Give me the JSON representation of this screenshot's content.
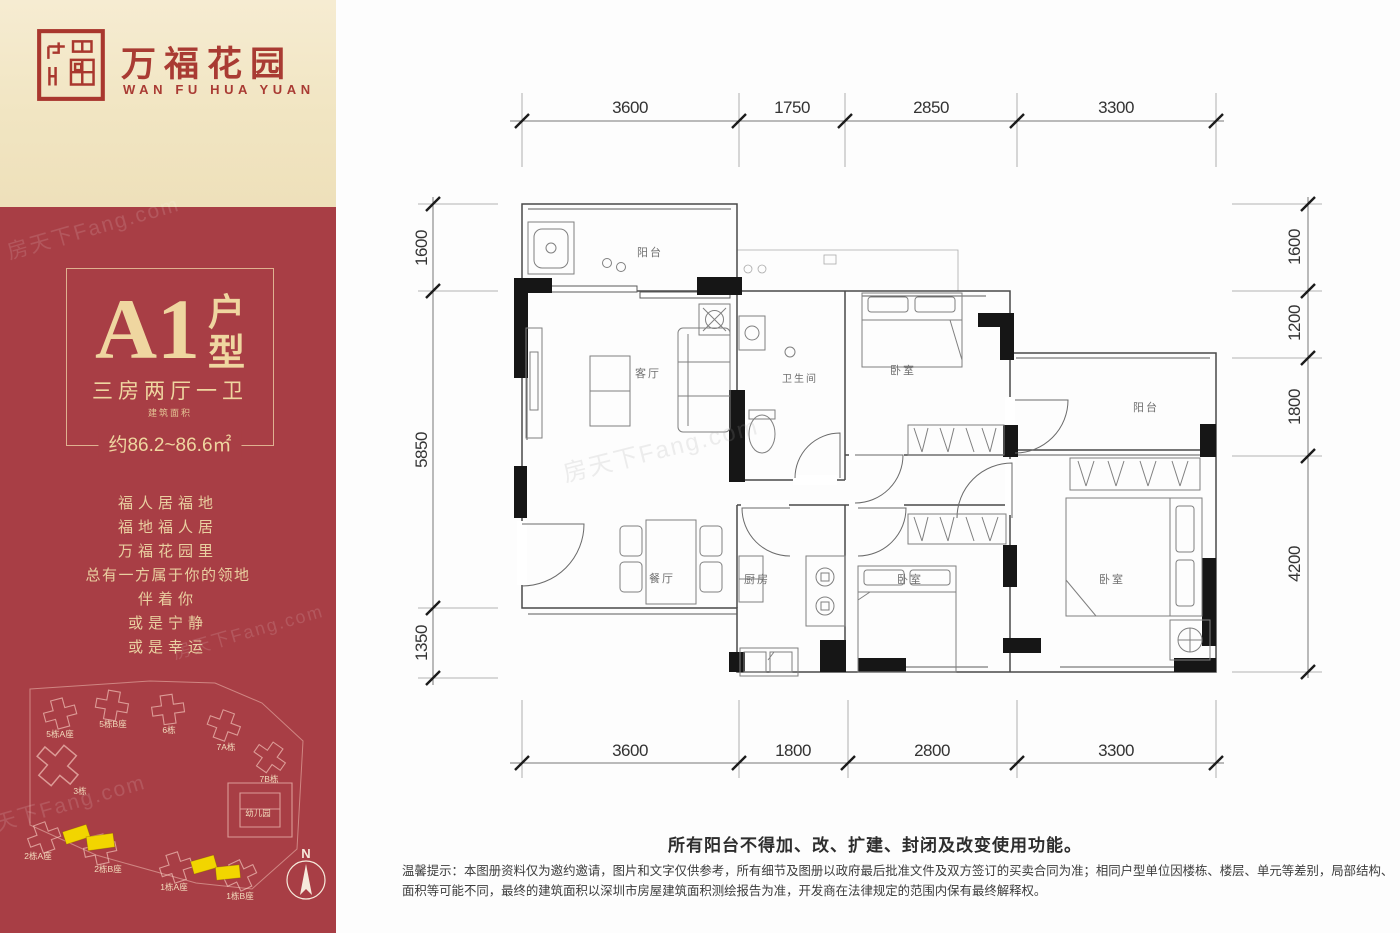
{
  "brand": {
    "name_cn": "万福花园",
    "name_en": "WAN FU HUA YUAN",
    "logo_color": "#A93B33"
  },
  "unit": {
    "code": "A1",
    "suffix_chars": [
      "户",
      "型"
    ],
    "layout": "三房两厅一卫",
    "area_label": "建筑面积",
    "area_value": "约86.2~86.6㎡"
  },
  "slogan": {
    "lines": [
      "福人居福地",
      "福地福人居",
      "万福花园里",
      "总有一方属于你的领地",
      "伴着你",
      "或是宁静",
      "或是幸运"
    ]
  },
  "site_plan": {
    "buildings": [
      "5栋A座",
      "5栋B座",
      "6栋",
      "7A栋",
      "7B栋",
      "3栋",
      "幼儿园",
      "2栋A座",
      "2栋B座",
      "1栋A座",
      "1栋B座"
    ],
    "compass": "N",
    "highlight_color": "#F2D500"
  },
  "floor_plan": {
    "rooms": {
      "balcony_top": "阳台",
      "living": "客厅",
      "bathroom": "卫生间",
      "bedroom_top": "卧室",
      "balcony_right": "阳台",
      "dining": "餐厅",
      "kitchen": "厨房",
      "bedroom_mid": "卧室",
      "bedroom_master": "卧室"
    },
    "dims_top": [
      "3600",
      "1750",
      "2850",
      "3300"
    ],
    "dims_bottom": [
      "3600",
      "1800",
      "2800",
      "3300"
    ],
    "dims_left": [
      "1600",
      "5850",
      "1350"
    ],
    "dims_right": [
      "1600",
      "1200",
      "1800",
      "4200"
    ]
  },
  "notes": {
    "balcony_notice": "所有阳台不得加、改、扩建、封闭及改变使用功能。",
    "disclaimer": "温馨提示：本图册资料仅为邀约邀请，图片和文字仅供参考，所有细节及图册以政府最后批准文件及双方签订的买卖合同为准；相同户型单位因楼栋、楼层、单元等差别，局部结构、面积等可能不同，最终的建筑面积以深圳市房屋建筑面积测绘报告为准，开发商在法律规定的范围内保有最终解释权。"
  },
  "watermark": {
    "text": "房天下Fang.com"
  },
  "colors": {
    "sidebar_red": "#A83E45",
    "header_cream": "#F1E5C2",
    "gold_text": "#EFD6A0",
    "plan_line": "#4a4a4a",
    "structural": "#161616"
  }
}
